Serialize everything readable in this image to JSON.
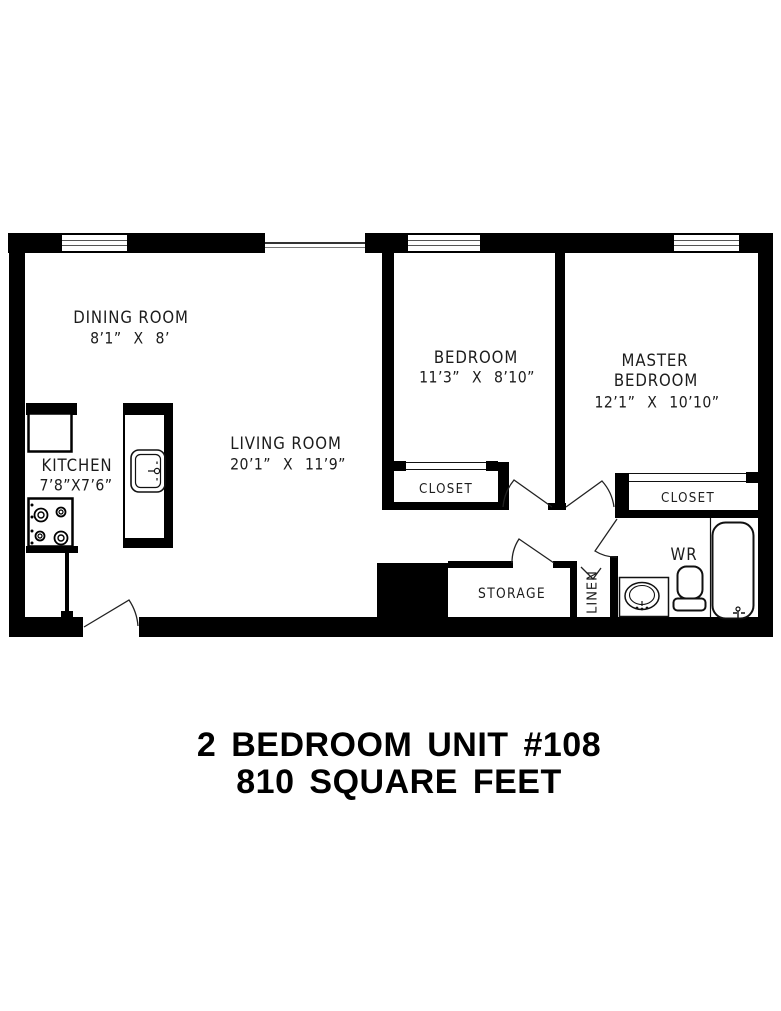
{
  "document": {
    "type": "apartment floor plan"
  },
  "title": {
    "line1": "2 BEDROOM UNIT #108",
    "line2": "810 SQUARE FEET"
  },
  "rooms": {
    "dining": {
      "name": "DINING ROOM",
      "dims": "8’1” X 8’"
    },
    "kitchen": {
      "name": "KITCHEN",
      "dims": "7’8”X7’6”"
    },
    "living": {
      "name": "LIVING ROOM",
      "dims": "20’1” X 11’9”"
    },
    "bedroom": {
      "name": "BEDROOM",
      "dims": "11’3” X 8’10”"
    },
    "master": {
      "line1": "MASTER",
      "line2": "BEDROOM",
      "dims": "12’1” X 10’10”"
    },
    "bedroom_closet": {
      "name": "CLOSET"
    },
    "master_closet": {
      "name": "CLOSET"
    },
    "storage": {
      "name": "STORAGE"
    },
    "linen": {
      "name": "LINEN"
    },
    "washroom": {
      "name": "WR"
    }
  },
  "fixtures": [
    "refrigerator",
    "stove",
    "kitchen-sink",
    "bathroom-sink",
    "toilet",
    "bathtub",
    "windows",
    "door-swings"
  ],
  "colors": {
    "walls": "#000000",
    "text": "#1c1c1c",
    "background": "#ffffff"
  }
}
